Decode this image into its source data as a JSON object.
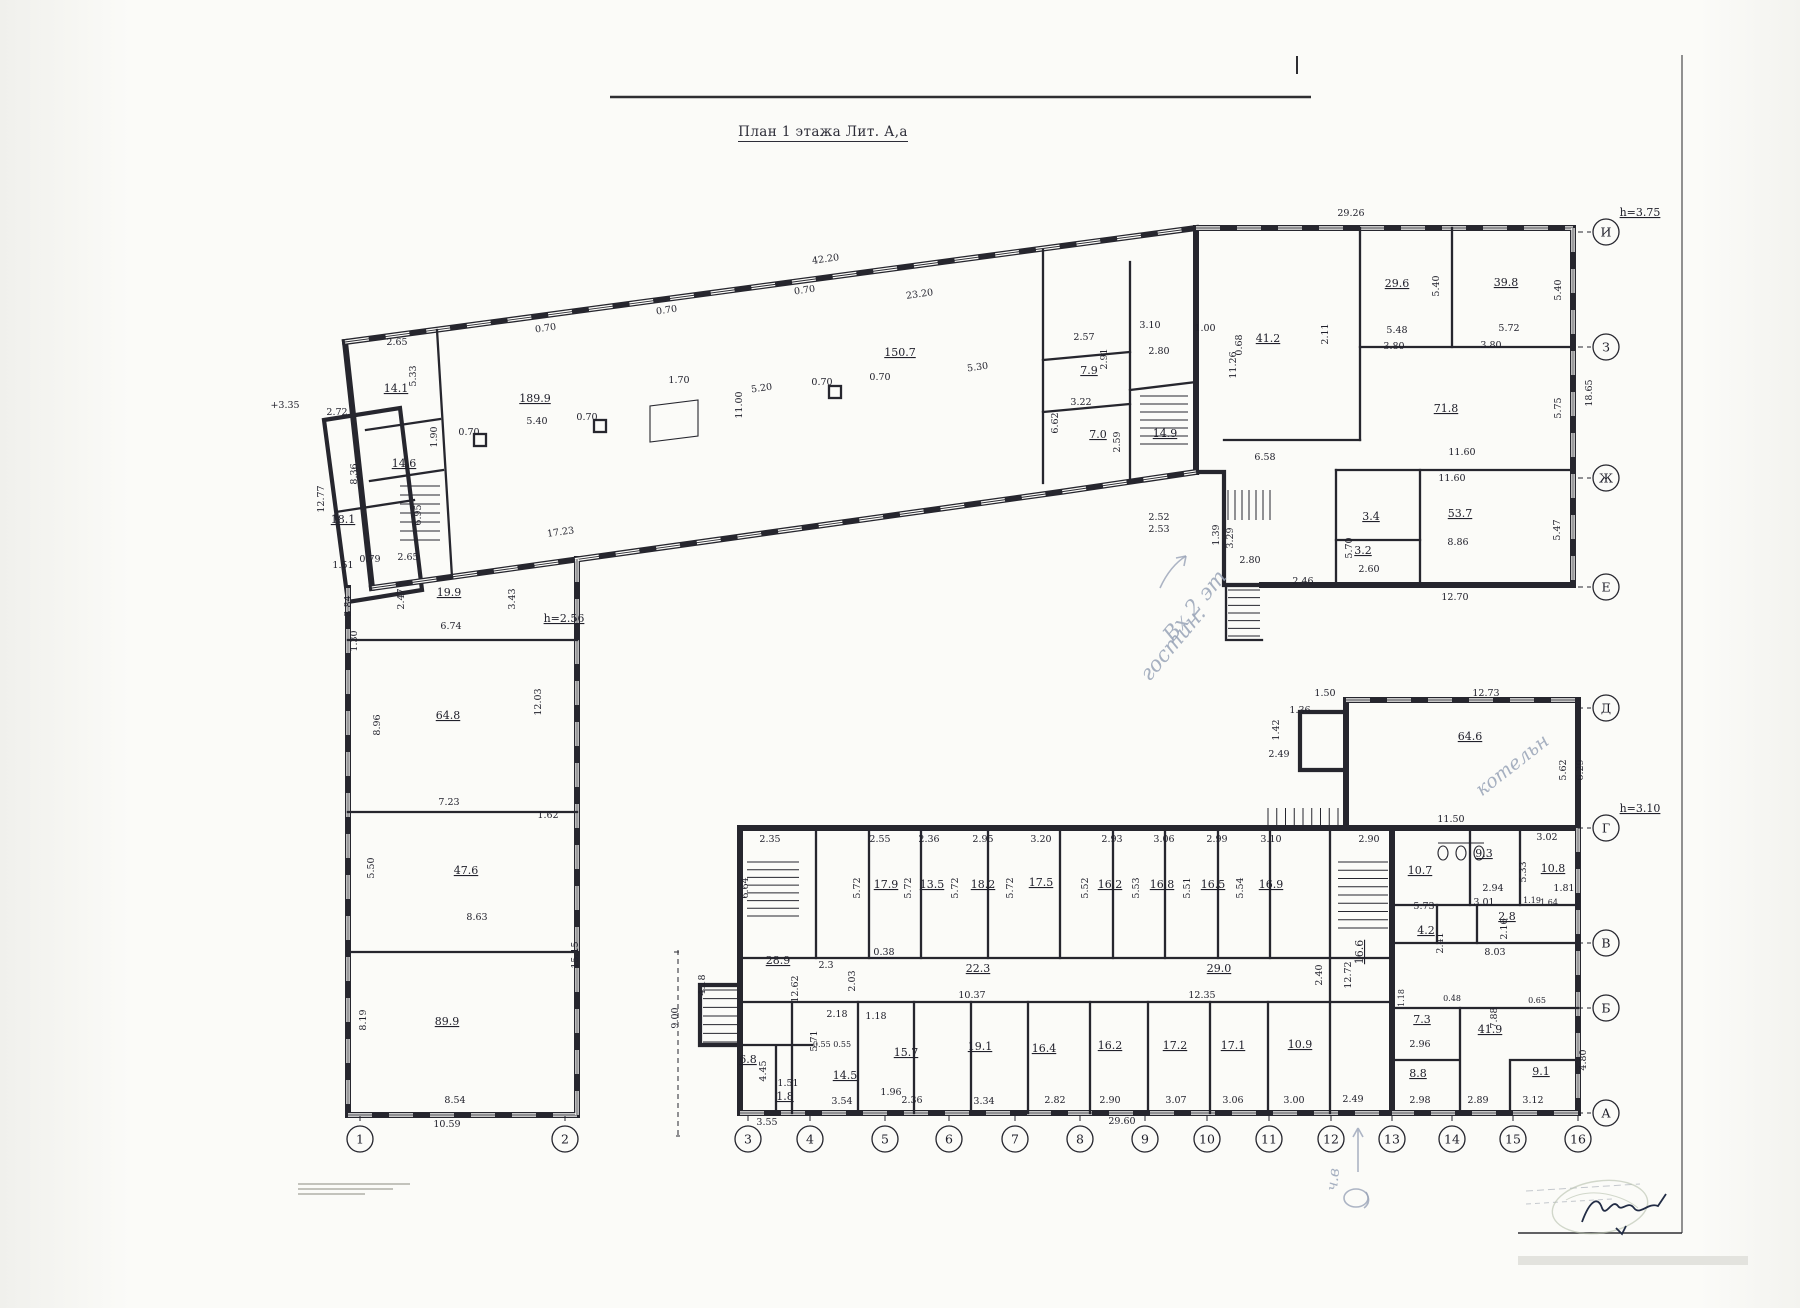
{
  "title": "План 1 этажа Лит. А,а",
  "axes": {
    "right": [
      {
        "label": "И",
        "y": 232,
        "note": "h=3.75"
      },
      {
        "label": "З",
        "y": 347
      },
      {
        "label": "Ж",
        "y": 478
      },
      {
        "label": "Е",
        "y": 587
      },
      {
        "label": "Д",
        "y": 708
      },
      {
        "label": "Г",
        "y": 828,
        "note": "h=3.10"
      },
      {
        "label": "В",
        "y": 943
      },
      {
        "label": "Б",
        "y": 1008
      },
      {
        "label": "А",
        "y": 1113
      }
    ],
    "bottom": [
      {
        "label": "1",
        "x": 360
      },
      {
        "label": "2",
        "x": 565
      },
      {
        "label": "3",
        "x": 748
      },
      {
        "label": "4",
        "x": 810
      },
      {
        "label": "5",
        "x": 885
      },
      {
        "label": "6",
        "x": 949
      },
      {
        "label": "7",
        "x": 1015
      },
      {
        "label": "8",
        "x": 1080
      },
      {
        "label": "9",
        "x": 1145
      },
      {
        "label": "10",
        "x": 1207
      },
      {
        "label": "11",
        "x": 1269
      },
      {
        "label": "12",
        "x": 1331
      },
      {
        "label": "13",
        "x": 1392
      },
      {
        "label": "14",
        "x": 1452
      },
      {
        "label": "15",
        "x": 1513
      },
      {
        "label": "16",
        "x": 1578
      }
    ]
  },
  "plan": {
    "labels": [
      {
        "t": "189.9",
        "x": 535,
        "y": 402,
        "u": 1
      },
      {
        "t": "5.40",
        "x": 537,
        "y": 424
      },
      {
        "t": "150.7",
        "x": 900,
        "y": 356,
        "u": 1
      },
      {
        "t": "11.00",
        "x": 742,
        "y": 405,
        "r": -90
      },
      {
        "t": "17.23",
        "x": 561,
        "y": 535,
        "r": -8
      },
      {
        "t": "5.20",
        "x": 762,
        "y": 391,
        "r": -8
      },
      {
        "t": "5.30",
        "x": 978,
        "y": 370,
        "r": -8
      },
      {
        "t": "42.20",
        "x": 826,
        "y": 262,
        "r": -8
      },
      {
        "t": "23.20",
        "x": 920,
        "y": 297,
        "r": -8
      },
      {
        "t": "29.26",
        "x": 1351,
        "y": 216
      },
      {
        "t": "0.70",
        "x": 546,
        "y": 331,
        "r": -8
      },
      {
        "t": "0.70",
        "x": 667,
        "y": 313,
        "r": -8
      },
      {
        "t": "0.70",
        "x": 805,
        "y": 293,
        "r": -8
      },
      {
        "t": "0.70",
        "x": 469,
        "y": 435
      },
      {
        "t": "0.70",
        "x": 587,
        "y": 420
      },
      {
        "t": "0.70",
        "x": 822,
        "y": 385
      },
      {
        "t": "0.70",
        "x": 880,
        "y": 380
      },
      {
        "t": "1.70",
        "x": 679,
        "y": 383
      },
      {
        "t": "14.1",
        "x": 396,
        "y": 392,
        "u": 1
      },
      {
        "t": "14.6",
        "x": 404,
        "y": 467,
        "u": 1
      },
      {
        "t": "2.65",
        "x": 397,
        "y": 345
      },
      {
        "t": "5.33",
        "x": 416,
        "y": 376,
        "r": -90
      },
      {
        "t": "1.90",
        "x": 437,
        "y": 437,
        "r": -90
      },
      {
        "t": "8.36",
        "x": 357,
        "y": 474,
        "r": -90
      },
      {
        "t": "6.95",
        "x": 421,
        "y": 515,
        "r": -90
      },
      {
        "t": "18.1",
        "x": 343,
        "y": 523,
        "u": 1
      },
      {
        "t": "12.77",
        "x": 324,
        "y": 499,
        "r": -90
      },
      {
        "t": "2.72",
        "x": 337,
        "y": 415
      },
      {
        "t": "+3.35",
        "x": 285,
        "y": 408
      },
      {
        "t": "1.51",
        "x": 343,
        "y": 568
      },
      {
        "t": "0.79",
        "x": 370,
        "y": 562
      },
      {
        "t": "2.65",
        "x": 408,
        "y": 560
      },
      {
        "t": "3.84",
        "x": 351,
        "y": 606,
        "r": -90
      },
      {
        "t": "1.30",
        "x": 357,
        "y": 641,
        "r": -90
      },
      {
        "t": "19.9",
        "x": 449,
        "y": 596,
        "u": 1
      },
      {
        "t": "6.74",
        "x": 451,
        "y": 629
      },
      {
        "t": "2.47",
        "x": 404,
        "y": 599,
        "r": -90
      },
      {
        "t": "3.43",
        "x": 515,
        "y": 599,
        "r": -90
      },
      {
        "t": "h=2.56",
        "x": 564,
        "y": 622,
        "u": 1
      },
      {
        "t": "2.57",
        "x": 1084,
        "y": 340
      },
      {
        "t": "2.91",
        "x": 1107,
        "y": 359,
        "r": -90
      },
      {
        "t": "3.10",
        "x": 1150,
        "y": 328
      },
      {
        "t": "2.80",
        "x": 1159,
        "y": 354
      },
      {
        "t": "7.9",
        "x": 1089,
        "y": 374,
        "u": 1
      },
      {
        "t": "3.22",
        "x": 1081,
        "y": 405
      },
      {
        "t": "7.0",
        "x": 1098,
        "y": 438,
        "u": 1
      },
      {
        "t": "2.59",
        "x": 1120,
        "y": 442,
        "r": -90
      },
      {
        "t": "14.9",
        "x": 1165,
        "y": 437,
        "u": 1
      },
      {
        "t": "6.62",
        "x": 1058,
        "y": 423,
        "r": -90
      },
      {
        "t": "1.00",
        "x": 1205,
        "y": 331
      },
      {
        "t": "0.68",
        "x": 1242,
        "y": 345,
        "r": -90
      },
      {
        "t": "11.26",
        "x": 1236,
        "y": 365,
        "r": -90
      },
      {
        "t": "41.2",
        "x": 1268,
        "y": 342,
        "u": 1
      },
      {
        "t": "2.11",
        "x": 1328,
        "y": 334,
        "r": -90
      },
      {
        "t": "2.52",
        "x": 1159,
        "y": 520
      },
      {
        "t": "2.53",
        "x": 1159,
        "y": 532
      },
      {
        "t": "2.80",
        "x": 1250,
        "y": 563
      },
      {
        "t": "1.39",
        "x": 1219,
        "y": 535,
        "r": -90
      },
      {
        "t": "3.29",
        "x": 1233,
        "y": 538,
        "r": -90
      },
      {
        "t": "2.46",
        "x": 1303,
        "y": 584
      },
      {
        "t": "29.6",
        "x": 1397,
        "y": 287,
        "u": 1
      },
      {
        "t": "5.40",
        "x": 1439,
        "y": 286,
        "r": -90
      },
      {
        "t": "39.8",
        "x": 1506,
        "y": 286,
        "u": 1
      },
      {
        "t": "5.40",
        "x": 1561,
        "y": 290,
        "r": -90
      },
      {
        "t": "5.48",
        "x": 1397,
        "y": 333
      },
      {
        "t": "3.80",
        "x": 1394,
        "y": 349
      },
      {
        "t": "5.72",
        "x": 1509,
        "y": 331
      },
      {
        "t": "3.80",
        "x": 1491,
        "y": 348
      },
      {
        "t": "71.8",
        "x": 1446,
        "y": 412,
        "u": 1
      },
      {
        "t": "5.75",
        "x": 1561,
        "y": 408,
        "r": -90
      },
      {
        "t": "18.65",
        "x": 1592,
        "y": 393,
        "r": -90
      },
      {
        "t": "11.60",
        "x": 1462,
        "y": 455
      },
      {
        "t": "11.60",
        "x": 1452,
        "y": 481
      },
      {
        "t": "53.7",
        "x": 1460,
        "y": 517,
        "u": 1
      },
      {
        "t": "5.47",
        "x": 1560,
        "y": 530,
        "r": -90
      },
      {
        "t": "8.86",
        "x": 1458,
        "y": 545
      },
      {
        "t": "12.70",
        "x": 1455,
        "y": 600
      },
      {
        "t": "6.58",
        "x": 1265,
        "y": 460
      },
      {
        "t": "3.4",
        "x": 1371,
        "y": 520,
        "u": 1
      },
      {
        "t": "3.2",
        "x": 1363,
        "y": 554,
        "u": 1
      },
      {
        "t": "5.70",
        "x": 1352,
        "y": 548,
        "r": -90
      },
      {
        "t": "2.60",
        "x": 1369,
        "y": 572
      },
      {
        "t": "64.8",
        "x": 448,
        "y": 719,
        "u": 1
      },
      {
        "t": "8.96",
        "x": 380,
        "y": 725,
        "r": -90
      },
      {
        "t": "12.03",
        "x": 541,
        "y": 702,
        "r": -90
      },
      {
        "t": "7.23",
        "x": 449,
        "y": 805
      },
      {
        "t": "1.62",
        "x": 548,
        "y": 818
      },
      {
        "t": "47.6",
        "x": 466,
        "y": 874,
        "u": 1
      },
      {
        "t": "5.50",
        "x": 374,
        "y": 868,
        "r": -90
      },
      {
        "t": "8.63",
        "x": 477,
        "y": 920
      },
      {
        "t": "15.15",
        "x": 578,
        "y": 955,
        "r": -90
      },
      {
        "t": "89.9",
        "x": 447,
        "y": 1025,
        "u": 1
      },
      {
        "t": "8.19",
        "x": 366,
        "y": 1020,
        "r": -90
      },
      {
        "t": "8.54",
        "x": 455,
        "y": 1103
      },
      {
        "t": "10.59",
        "x": 447,
        "y": 1127
      },
      {
        "t": "2.55",
        "x": 880,
        "y": 842
      },
      {
        "t": "2.36",
        "x": 929,
        "y": 842
      },
      {
        "t": "2.95",
        "x": 983,
        "y": 842
      },
      {
        "t": "3.20",
        "x": 1041,
        "y": 842
      },
      {
        "t": "2.93",
        "x": 1112,
        "y": 842
      },
      {
        "t": "3.06",
        "x": 1164,
        "y": 842
      },
      {
        "t": "2.99",
        "x": 1217,
        "y": 842
      },
      {
        "t": "3.10",
        "x": 1271,
        "y": 842
      },
      {
        "t": "2.90",
        "x": 1369,
        "y": 842
      },
      {
        "t": "17.9",
        "x": 886,
        "y": 888,
        "u": 1
      },
      {
        "t": "13.5",
        "x": 932,
        "y": 888,
        "u": 1
      },
      {
        "t": "18.2",
        "x": 983,
        "y": 888,
        "u": 1
      },
      {
        "t": "17.5",
        "x": 1041,
        "y": 886,
        "u": 1
      },
      {
        "t": "16.2",
        "x": 1110,
        "y": 888,
        "u": 1
      },
      {
        "t": "16.8",
        "x": 1162,
        "y": 888,
        "u": 1
      },
      {
        "t": "16.5",
        "x": 1213,
        "y": 888,
        "u": 1
      },
      {
        "t": "16.9",
        "x": 1271,
        "y": 888,
        "u": 1
      },
      {
        "t": "5.72",
        "x": 860,
        "y": 888,
        "r": -90
      },
      {
        "t": "5.72",
        "x": 911,
        "y": 888,
        "r": -90
      },
      {
        "t": "5.72",
        "x": 958,
        "y": 888,
        "r": -90
      },
      {
        "t": "5.72",
        "x": 1013,
        "y": 888,
        "r": -90
      },
      {
        "t": "5.52",
        "x": 1088,
        "y": 888,
        "r": -90
      },
      {
        "t": "5.53",
        "x": 1139,
        "y": 888,
        "r": -90
      },
      {
        "t": "5.51",
        "x": 1190,
        "y": 888,
        "r": -90
      },
      {
        "t": "5.54",
        "x": 1243,
        "y": 888,
        "r": -90
      },
      {
        "t": "22.3",
        "x": 978,
        "y": 972,
        "u": 1
      },
      {
        "t": "10.37",
        "x": 972,
        "y": 998
      },
      {
        "t": "29.0",
        "x": 1219,
        "y": 972,
        "u": 1
      },
      {
        "t": "12.35",
        "x": 1202,
        "y": 998
      },
      {
        "t": "2.3",
        "x": 826,
        "y": 968
      },
      {
        "t": "2.03",
        "x": 855,
        "y": 981,
        "r": -90
      },
      {
        "t": "12.62",
        "x": 798,
        "y": 989,
        "r": -90
      },
      {
        "t": "16.6",
        "x": 1363,
        "y": 952,
        "r": -90,
        "u": 1
      },
      {
        "t": "12.72",
        "x": 1351,
        "y": 975,
        "r": -90
      },
      {
        "t": "2.40",
        "x": 1322,
        "y": 975,
        "r": -90
      },
      {
        "t": "28.9",
        "x": 778,
        "y": 964,
        "u": 1
      },
      {
        "t": "2.35",
        "x": 770,
        "y": 842
      },
      {
        "t": "6.64",
        "x": 748,
        "y": 888,
        "r": -90
      },
      {
        "t": "0.38",
        "x": 884,
        "y": 955
      },
      {
        "t": "14.5",
        "x": 845,
        "y": 1079,
        "u": 1
      },
      {
        "t": "15.7",
        "x": 906,
        "y": 1056,
        "u": 1
      },
      {
        "t": "19.1",
        "x": 980,
        "y": 1050,
        "u": 1
      },
      {
        "t": "16.4",
        "x": 1044,
        "y": 1052,
        "u": 1
      },
      {
        "t": "16.2",
        "x": 1110,
        "y": 1049,
        "u": 1
      },
      {
        "t": "17.2",
        "x": 1175,
        "y": 1049,
        "u": 1
      },
      {
        "t": "17.1",
        "x": 1233,
        "y": 1049,
        "u": 1
      },
      {
        "t": "10.9",
        "x": 1300,
        "y": 1048,
        "u": 1
      },
      {
        "t": "2.18",
        "x": 837,
        "y": 1017
      },
      {
        "t": "1.18",
        "x": 876,
        "y": 1019
      },
      {
        "t": "5.71",
        "x": 817,
        "y": 1041,
        "r": -90
      },
      {
        "t": "0.55 0.55",
        "x": 832,
        "y": 1047,
        "s": 8
      },
      {
        "t": "1.96",
        "x": 891,
        "y": 1095
      },
      {
        "t": "3.54",
        "x": 842,
        "y": 1104
      },
      {
        "t": "2.36",
        "x": 912,
        "y": 1103
      },
      {
        "t": "3.34",
        "x": 984,
        "y": 1104
      },
      {
        "t": "2.82",
        "x": 1055,
        "y": 1103
      },
      {
        "t": "2.90",
        "x": 1110,
        "y": 1103
      },
      {
        "t": "3.07",
        "x": 1176,
        "y": 1103
      },
      {
        "t": "3.06",
        "x": 1233,
        "y": 1103
      },
      {
        "t": "3.00",
        "x": 1294,
        "y": 1103
      },
      {
        "t": "2.49",
        "x": 1353,
        "y": 1102
      },
      {
        "t": "29.60",
        "x": 1122,
        "y": 1124
      },
      {
        "t": "3.55",
        "x": 767,
        "y": 1125
      },
      {
        "t": "6.8",
        "x": 748,
        "y": 1063,
        "u": 1
      },
      {
        "t": "4.45",
        "x": 766,
        "y": 1071,
        "r": -90
      },
      {
        "t": "1.51",
        "x": 788,
        "y": 1086
      },
      {
        "t": "1.8",
        "x": 785,
        "y": 1100,
        "u": 1
      },
      {
        "t": "4.18",
        "x": 705,
        "y": 985,
        "r": -90
      },
      {
        "t": "9.00",
        "x": 678,
        "y": 1018,
        "r": -90
      },
      {
        "t": "10.7",
        "x": 1420,
        "y": 874,
        "u": 1
      },
      {
        "t": "9.3",
        "x": 1484,
        "y": 857,
        "u": 1
      },
      {
        "t": "3.02",
        "x": 1547,
        "y": 840
      },
      {
        "t": "10.8",
        "x": 1553,
        "y": 872,
        "u": 1
      },
      {
        "t": "5.33",
        "x": 1526,
        "y": 872,
        "r": -90
      },
      {
        "t": "2.94",
        "x": 1493,
        "y": 891
      },
      {
        "t": "3.01",
        "x": 1484,
        "y": 905
      },
      {
        "t": "2.8",
        "x": 1507,
        "y": 920,
        "u": 1
      },
      {
        "t": "1.19",
        "x": 1532,
        "y": 903,
        "s": 8
      },
      {
        "t": "1.64",
        "x": 1549,
        "y": 905,
        "s": 8
      },
      {
        "t": "1.81",
        "x": 1564,
        "y": 891
      },
      {
        "t": "5.73",
        "x": 1424,
        "y": 909
      },
      {
        "t": "4.2",
        "x": 1426,
        "y": 934,
        "u": 1
      },
      {
        "t": "2.41",
        "x": 1443,
        "y": 943,
        "r": -90
      },
      {
        "t": "8.03",
        "x": 1495,
        "y": 955
      },
      {
        "t": "2.16",
        "x": 1507,
        "y": 929,
        "r": -90
      },
      {
        "t": "0.48",
        "x": 1452,
        "y": 1001,
        "s": 8
      },
      {
        "t": "1.18",
        "x": 1404,
        "y": 998,
        "r": -90,
        "s": 8
      },
      {
        "t": "0.65",
        "x": 1537,
        "y": 1003,
        "s": 8
      },
      {
        "t": "7.88",
        "x": 1497,
        "y": 1018,
        "r": -90
      },
      {
        "t": "7.3",
        "x": 1422,
        "y": 1023,
        "u": 1
      },
      {
        "t": "2.96",
        "x": 1420,
        "y": 1047
      },
      {
        "t": "8.8",
        "x": 1418,
        "y": 1077,
        "u": 1
      },
      {
        "t": "41.9",
        "x": 1490,
        "y": 1033,
        "u": 1
      },
      {
        "t": "9.1",
        "x": 1541,
        "y": 1075,
        "u": 1
      },
      {
        "t": "4.80",
        "x": 1586,
        "y": 1060,
        "r": -90
      },
      {
        "t": "2.98",
        "x": 1420,
        "y": 1103
      },
      {
        "t": "2.89",
        "x": 1478,
        "y": 1103
      },
      {
        "t": "3.12",
        "x": 1533,
        "y": 1103
      },
      {
        "t": "64.6",
        "x": 1470,
        "y": 740,
        "u": 1
      },
      {
        "t": "11.50",
        "x": 1451,
        "y": 822
      },
      {
        "t": "12.73",
        "x": 1486,
        "y": 696
      },
      {
        "t": "1.50",
        "x": 1325,
        "y": 696
      },
      {
        "t": "1.36",
        "x": 1300,
        "y": 713
      },
      {
        "t": "1.42",
        "x": 1279,
        "y": 730,
        "r": -90
      },
      {
        "t": "2.49",
        "x": 1279,
        "y": 757
      },
      {
        "t": "5.62",
        "x": 1566,
        "y": 770,
        "r": -90
      },
      {
        "t": "6.29",
        "x": 1583,
        "y": 770,
        "r": -90
      }
    ]
  },
  "annotations": {
    "pencil": [
      {
        "t": "Вх 2 эт",
        "x": 1200,
        "y": 610,
        "rot": -50,
        "s": 21
      },
      {
        "t": "гостин.",
        "x": 1178,
        "y": 648,
        "rot": -50,
        "s": 21
      },
      {
        "t": "котельн",
        "x": 1516,
        "y": 770,
        "rot": -38,
        "s": 19
      },
      {
        "t": "ч.в",
        "x": 1338,
        "y": 1180,
        "rot": -84,
        "s": 15
      }
    ]
  },
  "colors": {
    "wall": "#26262e",
    "pencil_note": "#98a3b7",
    "ink_signature": "#222c45",
    "stamp": "#b6bfab"
  }
}
